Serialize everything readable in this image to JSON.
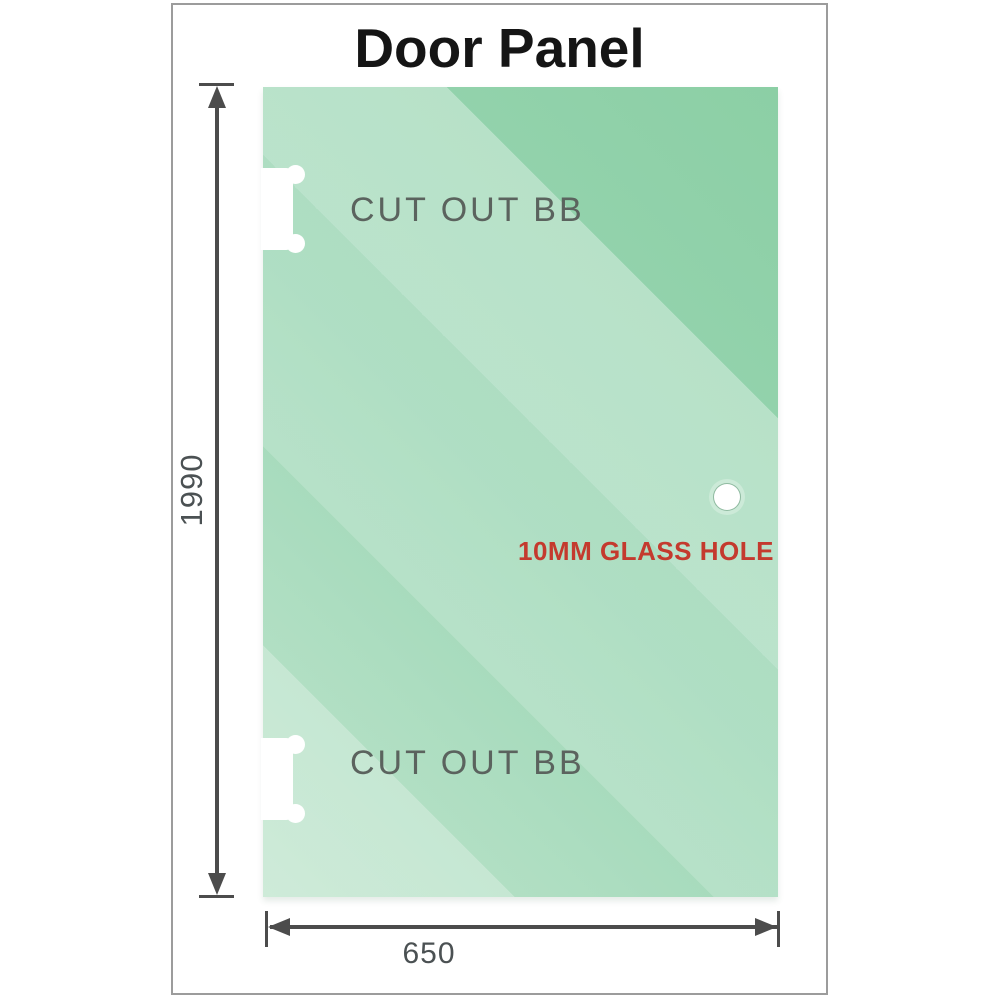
{
  "title": "Door Panel",
  "panel": {
    "cutout_label": "CUT OUT BB",
    "glass_hole_label": "10MM GLASS HOLE"
  },
  "dimensions": {
    "height": "1990",
    "width": "650"
  },
  "colors": {
    "glass_dark": "#8ccfa5",
    "glass_light": "#cdebd8",
    "dimension_line": "#4c4c4c",
    "cutout_label_gray": "#5b635e",
    "hole_label_red": "#c43a2e",
    "frame_border": "#9c9c9c",
    "title_black": "#151515"
  }
}
